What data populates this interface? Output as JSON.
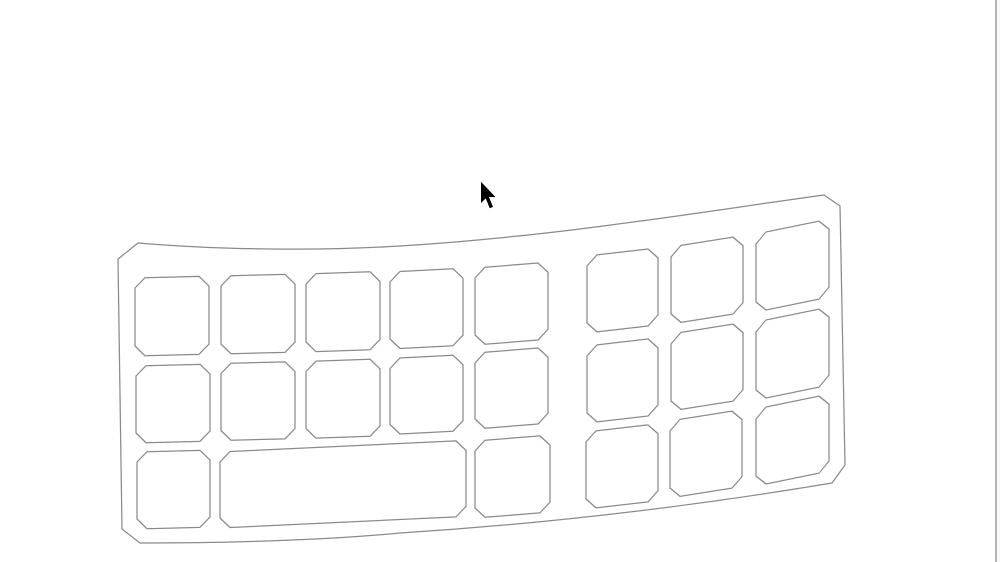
{
  "canvas": {
    "width": 1000,
    "height": 562,
    "background": "#ffffff",
    "description": "Blank white drawing canvas showing a wireframe line drawing of a curved ergonomic keyboard with chamfered-corner keys, and a black mouse arrow cursor above it"
  },
  "drawing": {
    "stroke_color": "#8a8a8a",
    "stroke_width": 1.25,
    "fill": "none",
    "key_chamfer": 10,
    "body_outline_path": "M 138,243 C 220,250 320,251 400,246 C 560,236 700,212 824,195 L 840,206 L 845,465 L 832,483 C 700,505 560,523 400,533 C 330,540 230,543 140,543 L 122,529 L 118,259 Z",
    "keys": [
      {
        "id": "left-r1-c1",
        "x": 135,
        "y": 278,
        "w": 74,
        "h": 78,
        "skew": -1.5
      },
      {
        "id": "left-r1-c2",
        "x": 221,
        "y": 276,
        "w": 74,
        "h": 78,
        "skew": -1.5
      },
      {
        "id": "left-r1-c3",
        "x": 306,
        "y": 274,
        "w": 74,
        "h": 78,
        "skew": -2
      },
      {
        "id": "left-r1-c4",
        "x": 390,
        "y": 272,
        "w": 73,
        "h": 77,
        "skew": -3
      },
      {
        "id": "left-r1-c5",
        "x": 475,
        "y": 268,
        "w": 73,
        "h": 77,
        "skew": -4.5
      },
      {
        "id": "left-r2-c1",
        "x": 136,
        "y": 366,
        "w": 74,
        "h": 77,
        "skew": -1.5
      },
      {
        "id": "left-r2-c2",
        "x": 221,
        "y": 363.5,
        "w": 74,
        "h": 77,
        "skew": -1.5
      },
      {
        "id": "left-r2-c3",
        "x": 306,
        "y": 361.5,
        "w": 74,
        "h": 77,
        "skew": -2
      },
      {
        "id": "left-r2-c4",
        "x": 390,
        "y": 358.5,
        "w": 73,
        "h": 76,
        "skew": -3
      },
      {
        "id": "left-r2-c5",
        "x": 475,
        "y": 353,
        "w": 73,
        "h": 76,
        "skew": -4.5
      },
      {
        "id": "left-r3-c1",
        "x": 137,
        "y": 452,
        "w": 73,
        "h": 77,
        "skew": -1.5
      },
      {
        "id": "spacebar",
        "x": 220,
        "y": 452,
        "w": 246,
        "h": 76,
        "skew": -2.7
      },
      {
        "id": "left-r3-c5",
        "x": 475,
        "y": 441,
        "w": 75,
        "h": 77,
        "skew": -4.5
      },
      {
        "id": "right-r1-c1",
        "x": 587,
        "y": 256,
        "w": 71,
        "h": 77,
        "skew": -6.5
      },
      {
        "id": "right-r1-c2",
        "x": 671,
        "y": 247,
        "w": 72,
        "h": 77,
        "skew": -9
      },
      {
        "id": "right-r1-c3",
        "x": 756,
        "y": 234,
        "w": 73,
        "h": 78,
        "skew": -11.5
      },
      {
        "id": "right-r2-c1",
        "x": 587,
        "y": 346,
        "w": 71,
        "h": 77,
        "skew": -6.5
      },
      {
        "id": "right-r2-c2",
        "x": 671,
        "y": 334,
        "w": 72,
        "h": 77,
        "skew": -9
      },
      {
        "id": "right-r2-c3",
        "x": 756,
        "y": 322,
        "w": 73,
        "h": 78,
        "skew": -11.5
      },
      {
        "id": "right-r3-c1",
        "x": 586,
        "y": 432,
        "w": 72,
        "h": 77,
        "skew": -6.5
      },
      {
        "id": "right-r3-c2",
        "x": 670,
        "y": 421,
        "w": 72,
        "h": 77,
        "skew": -9
      },
      {
        "id": "right-r3-c3",
        "x": 756,
        "y": 409,
        "w": 73,
        "h": 77,
        "skew": -11.5
      }
    ]
  },
  "cursor": {
    "fill": "#000000",
    "points": "480.7,181 480.7,203.7 485.6,198.9 489.6,208.6 493.4,207 489.4,197.4 496.2,197.4"
  },
  "right_edge": {
    "line_x": 995.2,
    "line_width": 1.4,
    "line_color": "#b4b4b4",
    "strip_x": 996.6,
    "strip_color": "#fafafa"
  }
}
